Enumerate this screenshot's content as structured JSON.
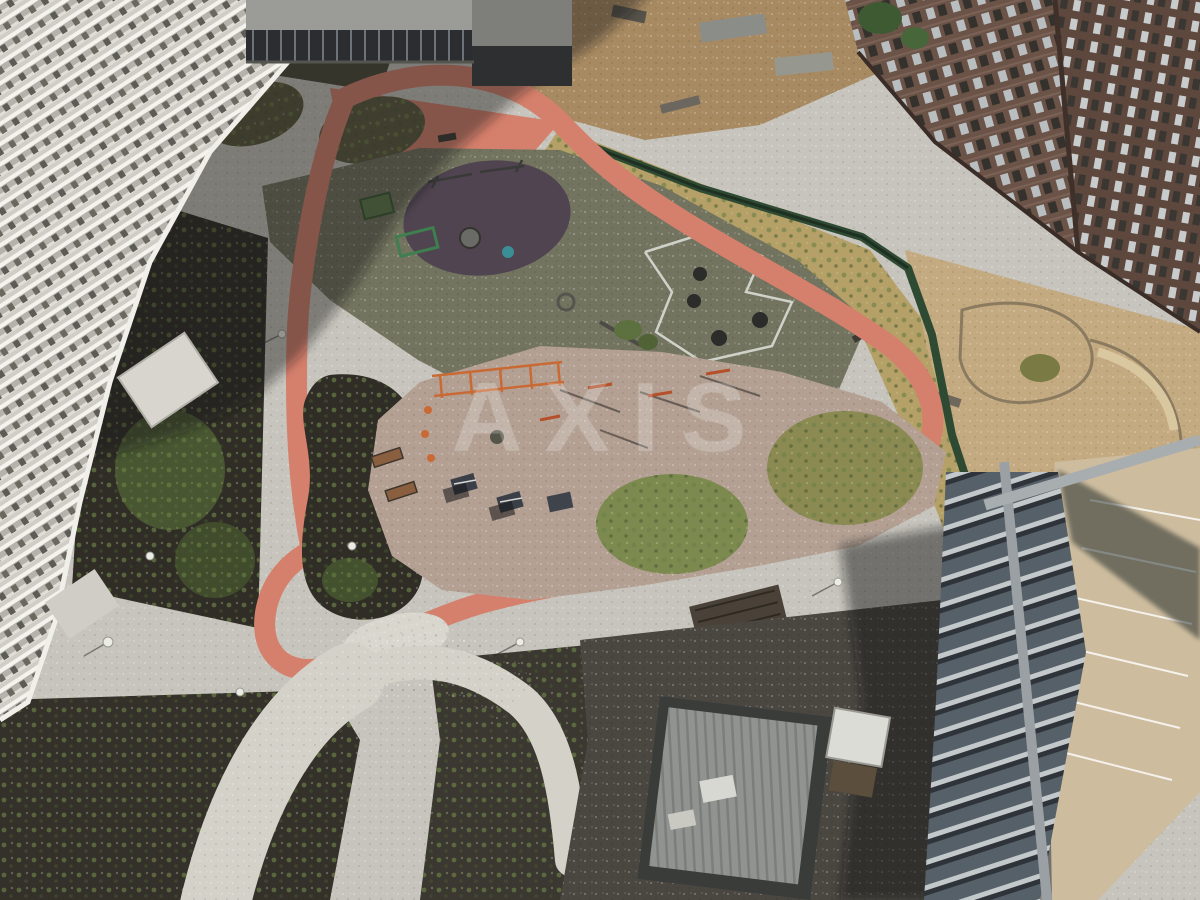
{
  "meta": {
    "type": "aerial-photo",
    "description": "Top-down drone photo of a new residential courtyard: two playgrounds (olive rubber pad with purple circle, pink workout pad) ringed by a salmon running track and pebble paving, dark planting islands, a white balcony tower on the left, a brown brick tower top-right, an under-construction concrete building bottom-right, a grey substation hut, a green site fence and a sandy neighbouring yard under construction. A large building shadow crosses the upper-left."
  },
  "watermark": {
    "text": "AXIS"
  },
  "palette": {
    "paving": "#c6c4bc",
    "pebble_path": "#d8d6cd",
    "track_salmon": "#d5806c",
    "mulch_dark": "#2f2d26",
    "grass_green": "#5d7040",
    "dry_grass": "#b5a067",
    "rubber_olive": "#73745f",
    "rubber_purple": "#4f4450",
    "workout_pink": "#b3a093",
    "building_white": "#e0ded7",
    "building_brown": "#6b5348",
    "slab_grey": "#566068",
    "deck_beige": "#cdbc9e",
    "fence_green": "#2f4a33",
    "asphalt": "#4a4741",
    "equipment_orange": "#c96a35",
    "shadow": "rgba(18,20,26,0.42)"
  },
  "scene": {
    "playgrounds": 2,
    "green_mounds": 2,
    "table_tennis_tables": 3,
    "towers_visible": 3
  }
}
